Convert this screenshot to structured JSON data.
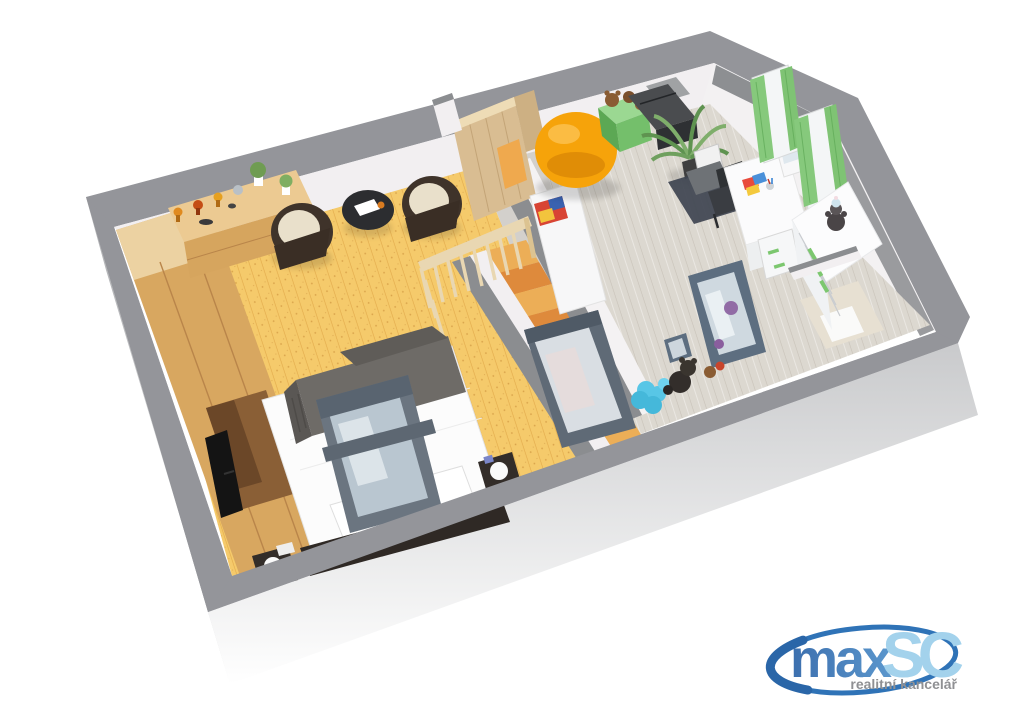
{
  "page": {
    "background": "#ffffff",
    "description": "3D cutaway floor plan of an attic apartment, viewed from above at an angle"
  },
  "logo": {
    "main": "max",
    "suffix": "SC",
    "tagline": "realitní kancelář",
    "colors": {
      "main": "#3c6fae",
      "main_light": "#5b97cd",
      "suffix": "#a3d2ec",
      "tagline": "#8f9093",
      "swoosh": "#2f73b7"
    }
  },
  "floorplan": {
    "view": "3d-cutaway-attic",
    "structure": {
      "roof_cut": "#94959a",
      "outer_face": "#b3b4b6",
      "bottom_face": "#c9cacc",
      "wall": "#f2eff1",
      "wall_top": "#8b8d90",
      "wood_partition": "#d9bd92",
      "door_glow": "#efa94e"
    },
    "rooms": {
      "bedroom": {
        "label": "bedroom",
        "floor_color": "#f5ca6b",
        "plank_line": "#e3ab4c"
      },
      "kids_room": {
        "label": "children's room",
        "floor_color": "#dcd8d0",
        "plank_line": "#c8c2b8"
      },
      "staircase": {
        "label": "staircase",
        "step_color": "#ecae57",
        "riser_color": "#de8a3c",
        "railing_color": "#e9d7b2"
      }
    },
    "objects": {
      "wardrobe": {
        "room": "bedroom",
        "color": "#d8a760",
        "top": "#ecd2a2",
        "niche": "#8a5f36"
      },
      "trophy_dresser": {
        "room": "bedroom",
        "color": "#ecca92",
        "front": "#d6a55e"
      },
      "trophies": {
        "room": "bedroom",
        "colors": [
          "#e08a1f",
          "#c44d15",
          "#e6a01f",
          "#b9c0c6"
        ]
      },
      "wicker_chairs": {
        "room": "bedroom",
        "count": 2,
        "color": "#3f332a",
        "cushion": "#e9e0cb"
      },
      "side_table": {
        "room": "bedroom",
        "color": "#2c2d30"
      },
      "double_bed": {
        "room": "bedroom",
        "color": "#fcfcfc",
        "blanket": "#6e6b67",
        "frame": "#2f2925"
      },
      "nightstands": {
        "room": "bedroom",
        "count": 2,
        "color": "#332d29",
        "lamp": "#fafafa"
      },
      "tv": {
        "room": "bedroom",
        "color": "#141414"
      },
      "roof_window_bedroom": {
        "frame": "#6b7580",
        "glass": "#b9c6d0"
      },
      "roof_window_staircase": {
        "frame": "#5f6a76",
        "glass": "#d9dee3"
      },
      "bean_bag": {
        "room": "kids_room",
        "color": "#f6a30a",
        "shade": "#e08d06",
        "highlight": "#fcc14d"
      },
      "toy_box": {
        "room": "kids_room",
        "color": "#74bf6b",
        "top": "#9bd892"
      },
      "teddy_bears": {
        "room": "kids_room",
        "color": "#8a5c33"
      },
      "storage_cases": {
        "room": "kids_room",
        "color": "#4a4c4f"
      },
      "palm_plant": {
        "room": "kids_room",
        "color": "#5f9350",
        "color2": "#7fae6b"
      },
      "desk": {
        "room": "kids_room",
        "color": "#fbfbfc",
        "handle": "#7cc76f"
      },
      "desk_chairs": {
        "room": "kids_room",
        "count": 2,
        "color": "#3a3d42"
      },
      "floor_mat": {
        "room": "kids_room",
        "color": "#3e4450"
      },
      "curtains": {
        "room": "kids_room",
        "count": 2,
        "color": "#86c97c",
        "fold": "#5ea856"
      },
      "white_dresser": {
        "room": "kids_room",
        "color": "#fcfcfd",
        "handle": "#7cc76f"
      },
      "dresser_teddy": {
        "room": "kids_room",
        "color": "#4a4547",
        "cap": "#cfe4ee"
      },
      "mirror": {
        "room": "kids_room",
        "frame": "#5d6e80",
        "glass": "#cfd9e0"
      },
      "plush_toy_blue": {
        "room": "kids_room",
        "color": "#58c6e6"
      },
      "plush_toy_black": {
        "room": "kids_room",
        "color": "#332e2b"
      },
      "magazine_bench": {
        "room": "kids_room",
        "color": "#f7f7f8",
        "magazine": [
          "#d84434",
          "#3a62b0",
          "#f2c43d"
        ]
      }
    }
  }
}
